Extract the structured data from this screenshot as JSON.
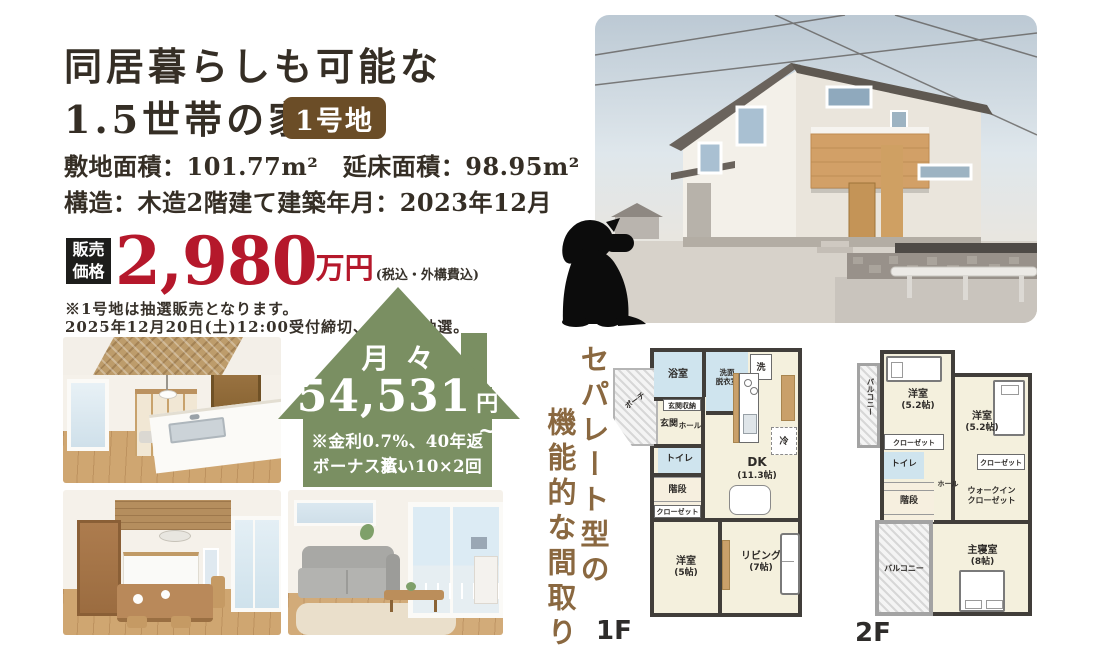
{
  "colors": {
    "accent_red": "#b5182b",
    "badge_brown": "#6b4d27",
    "loan_house_green": "#7a8f62",
    "catchcopy_brown": "#8a6840",
    "plan_wall_gray": "#413e3a",
    "plan_wet_blue": "#cfe4ee",
    "plan_floor_cream": "#f4f0dd"
  },
  "header": {
    "title_line1": "同居暮らしも可能な",
    "title_line2": "1.5世帯の家",
    "lot_badge": "1号地",
    "spec_line1": "敷地面積：101.77m²　延床面積：98.95m²",
    "spec_line2": "構造：木造2階建て建築年月：2023年12月"
  },
  "price": {
    "label_top": "販売",
    "label_bottom": "価格",
    "amount": "2,980",
    "unit": "万円",
    "tax_note": "(税込・外構費込)",
    "lottery_note1": "※1号地は抽選販売となります。",
    "lottery_note2": "2025年12月20日(土)12:00受付締切、12:30抽選。"
  },
  "monthly": {
    "label": "月々",
    "amount": "54,531",
    "unit": "円~",
    "terms1": "※金利0.7%、40年返済、",
    "terms2": "ボーナス払い10×2回"
  },
  "catchcopy": {
    "line1": "セパレート型の",
    "line2": "機能的な間取り"
  },
  "plan1f": {
    "floor_label": "1F",
    "porch": "ポーチ",
    "bath": "浴室",
    "washroom_l1": "洗面",
    "washroom_l2": "脱衣室",
    "laundry": "洗",
    "entrance_storage": "玄関収納",
    "entrance": "玄関",
    "hall": "ホール",
    "toilet": "トイレ",
    "stairs": "階段",
    "closet": "クローゼット",
    "dk": "DK",
    "dk_size": "(11.3帖)",
    "fridge": "冷",
    "bedroom": "洋室",
    "bedroom_size": "(5帖)",
    "living": "リビング",
    "living_size": "(7帖)"
  },
  "plan2f": {
    "floor_label": "2F",
    "balcony_side": "バルコニー",
    "bedroom1": "洋室",
    "bedroom1_size": "(5.2帖)",
    "bedroom2": "洋室",
    "bedroom2_size": "(5.2帖)",
    "closet1": "クローゼット",
    "closet2": "クローゼット",
    "toilet": "トイレ",
    "stairs": "階段",
    "hall": "ホール",
    "wic_l1": "ウォークイン",
    "wic_l2": "クローゼット",
    "master": "主寝室",
    "master_size": "(8帖)",
    "balcony": "バルコニー"
  }
}
